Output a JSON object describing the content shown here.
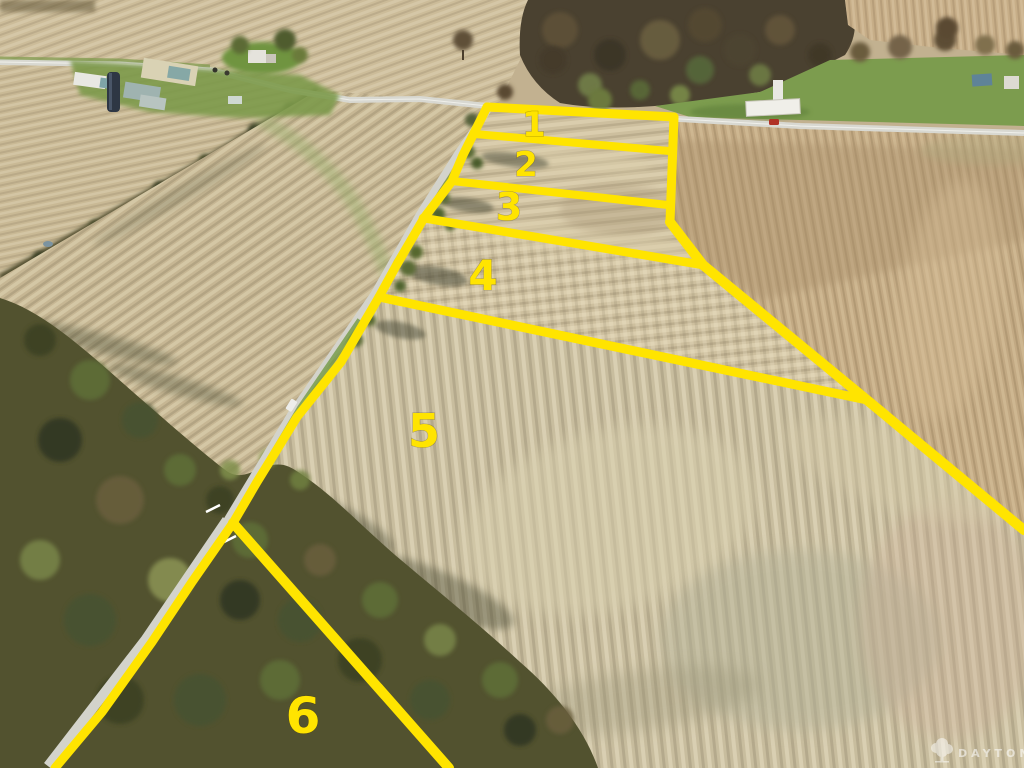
{
  "scene": {
    "type": "aerial-photograph",
    "subject": "Farmland plat photo with six numbered lots outlined in yellow"
  },
  "lots": [
    {
      "label": "1"
    },
    {
      "label": "2"
    },
    {
      "label": "3"
    },
    {
      "label": "4"
    },
    {
      "label": "5"
    },
    {
      "label": "6"
    }
  ],
  "watermark": {
    "text": "DAYTON",
    "icon": "tree-icon"
  },
  "colors": {
    "boundary_yellow": "#ffe400",
    "lot_number_yellow": "#ffe400",
    "field_tan": "#c2b190",
    "field_light_tan": "#cdbf9e",
    "field_warm_brown": "#c2a983",
    "grass_green": "#6f9440",
    "woods_dark_olive": "#4f4a2e",
    "road_grey": "#d6d6cf",
    "red_car": "#b03226",
    "watermark_white": "#ffffff"
  }
}
